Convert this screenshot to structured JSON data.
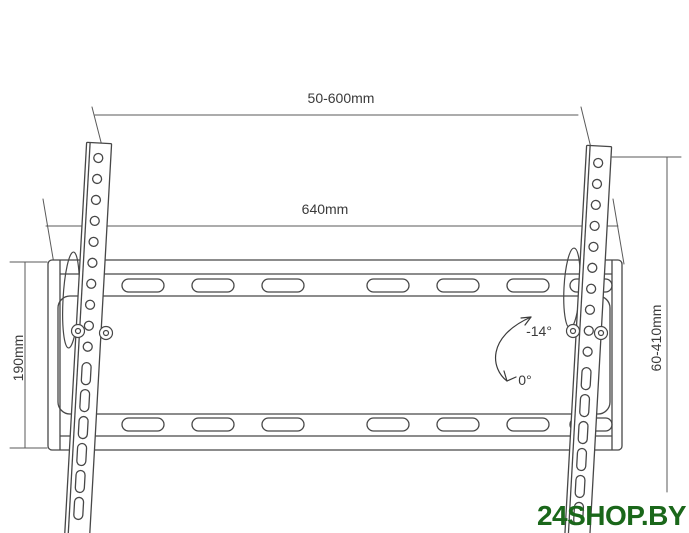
{
  "diagram": {
    "labels": {
      "bracket_spread": "50-600mm",
      "plate_width": "640mm",
      "plate_height": "190mm",
      "height_range": "60-410mm",
      "tilt_max": "-14°",
      "tilt_min": "0°"
    },
    "colors": {
      "line": "#474747",
      "dimension": "#5a5a5a",
      "text": "#3a3a3a",
      "watermark": "#1a671a"
    }
  },
  "watermark": {
    "text": "24SHOP.BY"
  }
}
